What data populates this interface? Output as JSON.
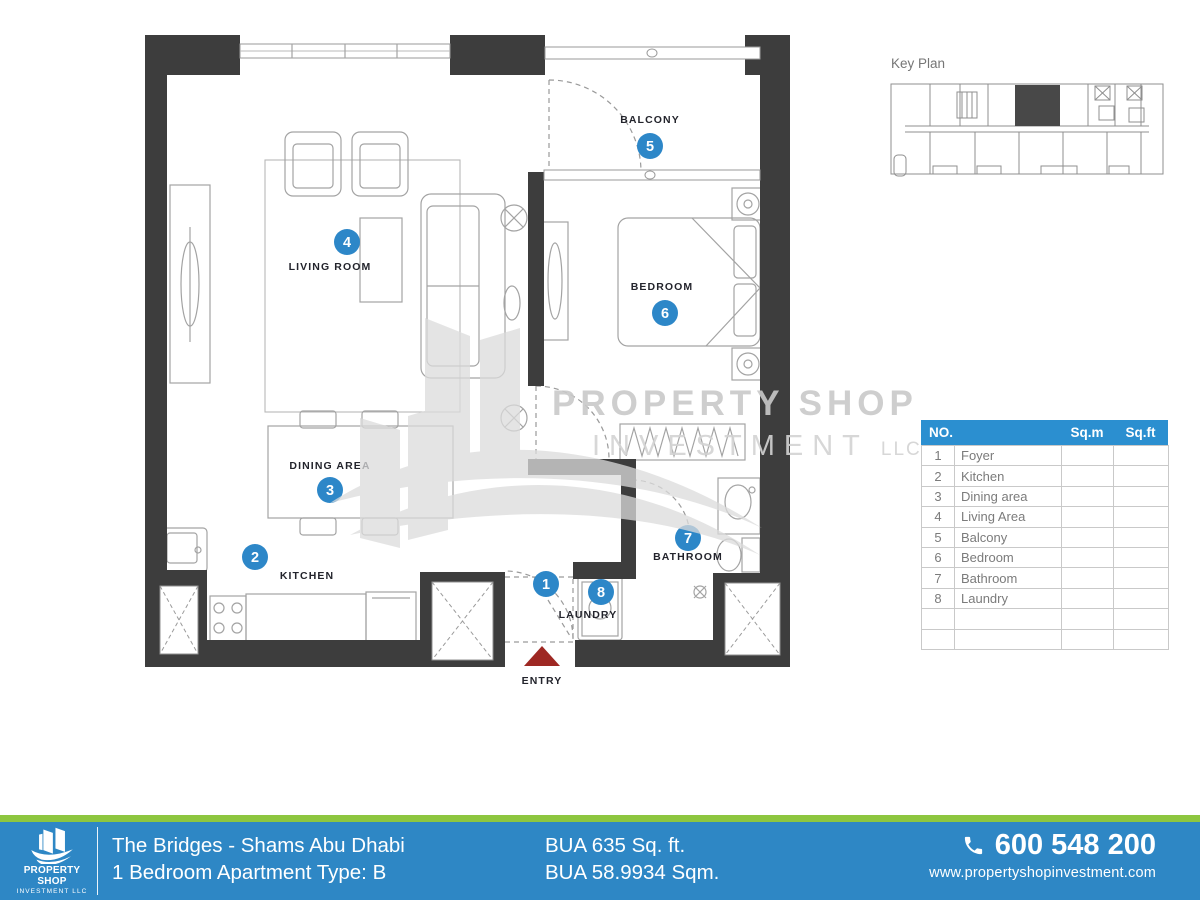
{
  "key_plan": {
    "title": "Key Plan"
  },
  "plan": {
    "wall_color": "#3d3d3d",
    "marker_color": "#2d87c8",
    "entry_arrow_color": "#9e2823",
    "rooms": [
      {
        "no": "1",
        "label": ""
      },
      {
        "no": "2",
        "label": "KITCHEN"
      },
      {
        "no": "3",
        "label": "DINING AREA"
      },
      {
        "no": "4",
        "label": "LIVING ROOM"
      },
      {
        "no": "5",
        "label": "BALCONY"
      },
      {
        "no": "6",
        "label": "BEDROOM"
      },
      {
        "no": "7",
        "label": "BATHROOM"
      },
      {
        "no": "8",
        "label": "LAUNDRY"
      }
    ],
    "entry_label": "ENTRY"
  },
  "watermark": {
    "line1": "PROPERTY SHOP",
    "line2": "INVESTMENT",
    "suffix": "LLC"
  },
  "area_table": {
    "col_no": "NO.",
    "col_sqm": "Sq.m",
    "col_sqft": "Sq.ft",
    "header_bg": "#2b8fd0",
    "rows": [
      {
        "no": "1",
        "name": "Foyer",
        "sqm": "",
        "sqft": ""
      },
      {
        "no": "2",
        "name": "Kitchen",
        "sqm": "",
        "sqft": ""
      },
      {
        "no": "3",
        "name": "Dining area",
        "sqm": "",
        "sqft": ""
      },
      {
        "no": "4",
        "name": "Living Area",
        "sqm": "",
        "sqft": ""
      },
      {
        "no": "5",
        "name": "Balcony",
        "sqm": "",
        "sqft": ""
      },
      {
        "no": "6",
        "name": "Bedroom",
        "sqm": "",
        "sqft": ""
      },
      {
        "no": "7",
        "name": "Bathroom",
        "sqm": "",
        "sqft": ""
      },
      {
        "no": "8",
        "name": "Laundry",
        "sqm": "",
        "sqft": ""
      },
      {
        "no": "",
        "name": "",
        "sqm": "",
        "sqft": ""
      },
      {
        "no": "",
        "name": "",
        "sqm": "",
        "sqft": ""
      }
    ]
  },
  "footer": {
    "bar_color": "#2e87c5",
    "accent_color": "#8dc63f",
    "logo": {
      "line1": "PROPERTY SHOP",
      "line2": "INVESTMENT LLC"
    },
    "project": "The Bridges - Shams Abu Dhabi",
    "unit": "1 Bedroom Apartment Type: B",
    "bua_ft": "BUA 635 Sq. ft.",
    "bua_sqm": "BUA 58.9934 Sqm.",
    "phone": "600 548 200",
    "website": "www.propertyshopinvestment.com"
  }
}
